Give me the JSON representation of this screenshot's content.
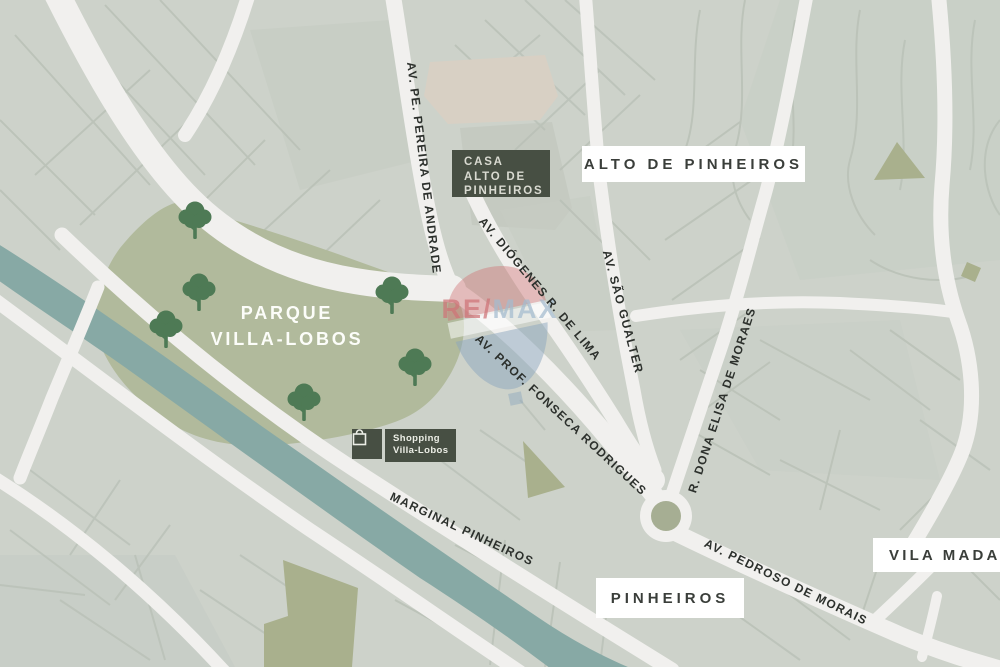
{
  "park": {
    "name_line1": "PARQUE",
    "name_line2": "VILLA-LOBOS"
  },
  "property_badge": {
    "line1": "CASA",
    "line2": "ALTO DE",
    "line3": "PINHEIROS"
  },
  "shopping_badge": {
    "line1": "Shopping",
    "line2": "Villa-Lobos"
  },
  "watermark": {
    "part1": "RE",
    "part2": "/",
    "part3": "MAX"
  },
  "area_labels": [
    {
      "text": "ALTO DE PINHEIROS"
    },
    {
      "text": "PINHEIROS"
    },
    {
      "text": "VILA MADALENA"
    }
  ],
  "street_labels": [
    {
      "text": "AV. PE. PEREIRA DE ANDRADE"
    },
    {
      "text": "AV. DIÓGENES R. DE LIMA"
    },
    {
      "text": "AV. SÃO GUALTER"
    },
    {
      "text": "AV. PROF. FONSECA RODRIGUES"
    },
    {
      "text": "R. DONA ELISA DE MORAES"
    },
    {
      "text": "MARGINAL PINHEIROS"
    },
    {
      "text": "AV. PEDROSO DE MORAIS"
    }
  ],
  "icons": {
    "shopping_bag": "shopping-bag-icon",
    "trees": "tree-icon",
    "balloon": "remax-balloon-icon"
  },
  "colors": {
    "map_base": "#cdd2ca",
    "road": "#f1f0ee",
    "minor_street": "#b9c0b6",
    "park": "#b1ba9c",
    "tree": "#4e7a55",
    "river": "#87a9a5",
    "badge_bg": "#474f43",
    "badge_text": "#d9dad1",
    "label_text": "#2c302c",
    "box_bg": "#ffffff",
    "roundabout": "#a6ae93",
    "olive_patch": "#a9b08d",
    "beige_block": "#d8d0c4",
    "remax_red": "#cf6b6f",
    "remax_blue": "#8ca6bd"
  }
}
